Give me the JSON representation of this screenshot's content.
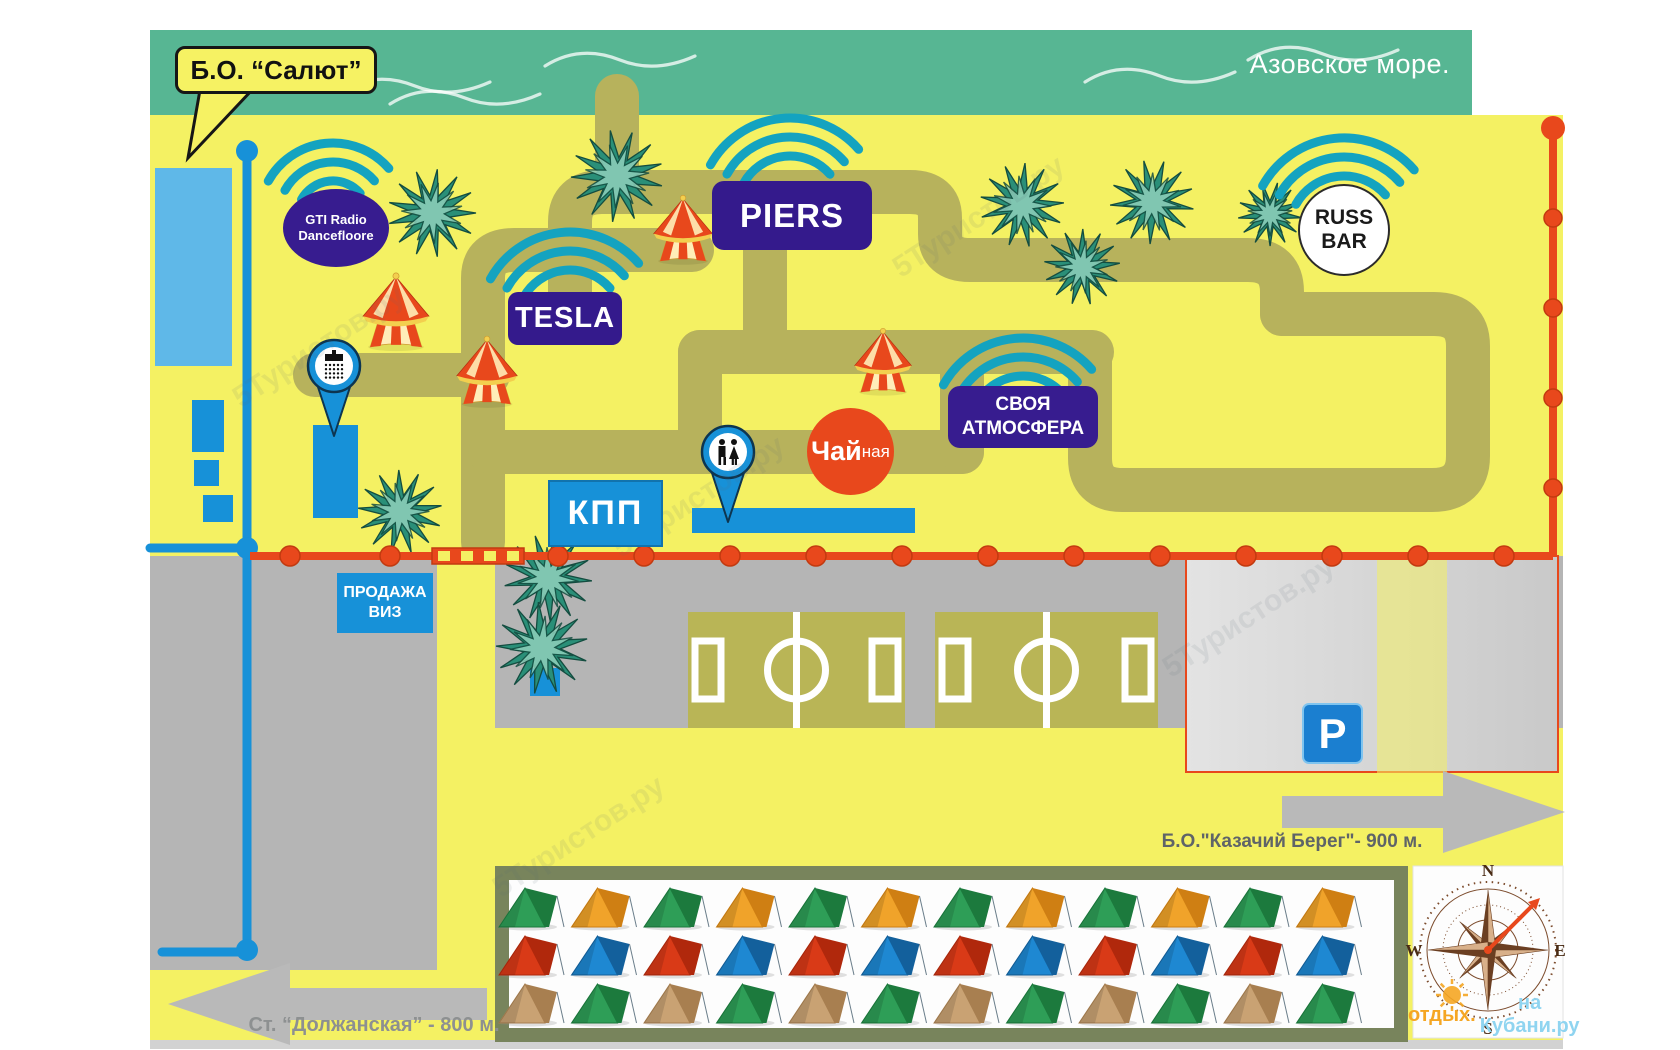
{
  "map": {
    "title": "Б.О. “Салют”",
    "sea_label": "Азовское море.",
    "labels": {
      "gti_line1": "GTI Radio",
      "gti_line2": "Dancefloore",
      "tesla": "TESLA",
      "piers": "PIERS",
      "svoya_line1": "СВОЯ",
      "svoya_line2": "АТМОСФЕРА",
      "russ_line1": "RUSS",
      "russ_line2": "BAR",
      "tea_main": "Чай",
      "tea_suffix": "ная",
      "kpp": "КПП",
      "visa_line1": "ПРОДАЖА",
      "visa_line2": "ВИЗ",
      "parking": "P"
    },
    "directions": {
      "right": "Б.О.\"Казачий Берег\"- 900 м.",
      "left": "Ст. “Должанская”  - 800 м."
    },
    "compass": {
      "n": "N",
      "e": "E",
      "s": "S",
      "w": "W"
    },
    "watermarks": {
      "site": "5Туристов.ру",
      "footer_orange": "отдых.",
      "footer_blue": "на Кубани.ру"
    },
    "camp": {
      "rows": [
        [
          "green",
          "orange",
          "green",
          "orange",
          "green",
          "orange",
          "green",
          "orange",
          "green",
          "orange",
          "green",
          "orange"
        ],
        [
          "red",
          "blue",
          "red",
          "blue",
          "red",
          "blue",
          "red",
          "blue",
          "red",
          "blue",
          "red",
          "blue"
        ],
        [
          "tan",
          "green",
          "tan",
          "green",
          "tan",
          "green",
          "tan",
          "green",
          "tan",
          "green",
          "tan",
          "green"
        ]
      ]
    },
    "colors": {
      "yellow": "#f4f163",
      "sea": "#57b693",
      "path": "#b7b25c",
      "gray": "#b5b5b5",
      "blue": "#1791d8",
      "indigo": "#371c8f",
      "red": "#e8481c",
      "wifi": "#14a3c0",
      "field": "#b9b556",
      "tree_dark": "#2a8f78",
      "tree_light": "#8fd0bb",
      "frame": "#78845c",
      "tent_green": [
        "#2e9e57",
        "#1c7a3d"
      ],
      "tent_orange": [
        "#f0a32a",
        "#cf7f13"
      ],
      "tent_red": [
        "#d93a17",
        "#b0280c"
      ],
      "tent_blue": [
        "#1e88d2",
        "#13609c"
      ],
      "tent_tan": [
        "#c9a273",
        "#a87f50"
      ]
    }
  }
}
